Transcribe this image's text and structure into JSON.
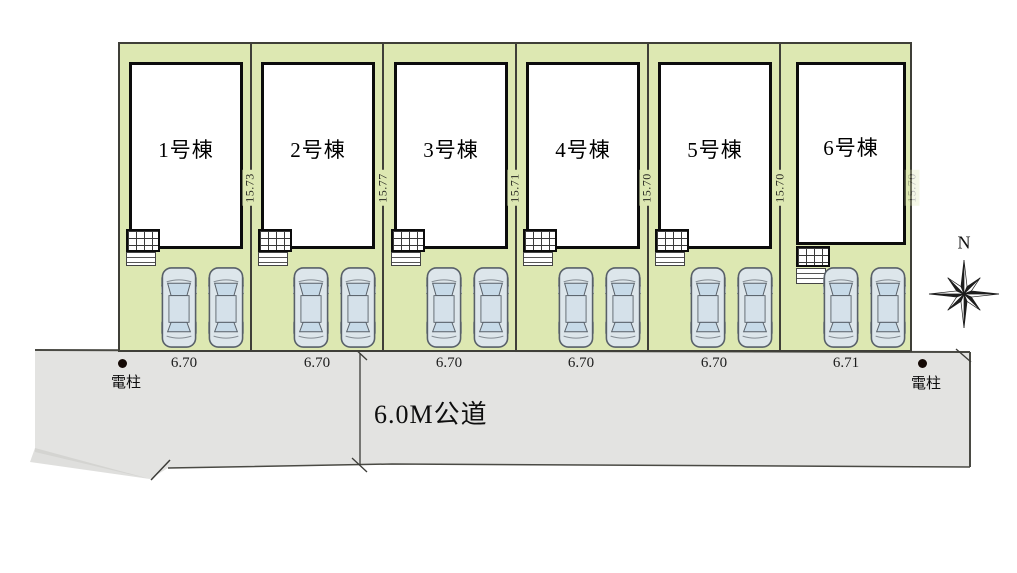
{
  "plan": {
    "compass_label": "N",
    "road_label": "6.0M公道",
    "pole_left_label": "電柱",
    "pole_right_label": "電柱",
    "lots": [
      {
        "building": "1号棟",
        "depth": "15.73",
        "frontage": "6.70"
      },
      {
        "building": "2号棟",
        "depth": "15.77",
        "frontage": "6.70"
      },
      {
        "building": "3号棟",
        "depth": "15.71",
        "frontage": "6.70"
      },
      {
        "building": "4号棟",
        "depth": "15.70",
        "frontage": "6.70"
      },
      {
        "building": "5号棟",
        "depth": "15.70",
        "frontage": "6.70"
      },
      {
        "building": "6号棟",
        "depth": "15.70",
        "frontage": "6.71"
      }
    ],
    "colors": {
      "lot_fill": "#dde8b2",
      "road_fill": "#e3e3e1",
      "building_fill": "#ffffff",
      "outline": "#3f3f38",
      "car_body": "#dde6eb",
      "car_glass": "#c7dae8"
    }
  }
}
